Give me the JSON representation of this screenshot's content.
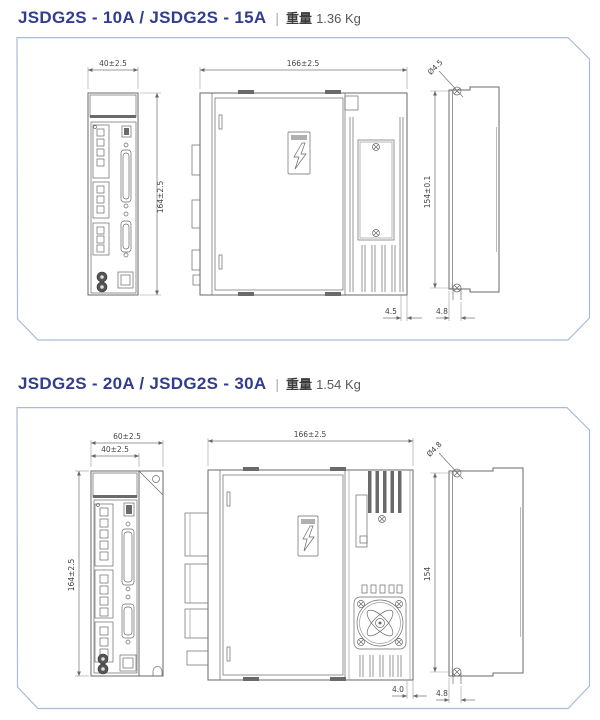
{
  "colors": {
    "title_accent": "#333d90",
    "panel_border": "#a9bbd6",
    "drawing_line": "#6a6a6a",
    "dimension_text": "#444444"
  },
  "sections": [
    {
      "model_title": "JSDG2S - 10A / JSDG2S - 15A",
      "separator": "|",
      "weight_label": "重量",
      "weight_value": "1.36 Kg",
      "dims": {
        "front_width": "40±2.5",
        "front_height": "164±2.5",
        "side_width": "166±2.5",
        "side_bottom_offset": "4.5",
        "mount_hole": "Ø4.5",
        "mount_pitch": "154±0.1",
        "mount_slot": "4.8"
      }
    },
    {
      "model_title": "JSDG2S - 20A / JSDG2S - 30A",
      "separator": "|",
      "weight_label": "重量",
      "weight_value": "1.54 Kg",
      "dims": {
        "front_outer_width": "60±2.5",
        "front_width": "40±2.5",
        "front_height": "164±2.5",
        "side_width": "166±2.5",
        "side_bottom_offset": "4.0",
        "mount_hole": "Ø4.8",
        "mount_pitch": "154",
        "mount_slot": "4.8"
      }
    }
  ]
}
